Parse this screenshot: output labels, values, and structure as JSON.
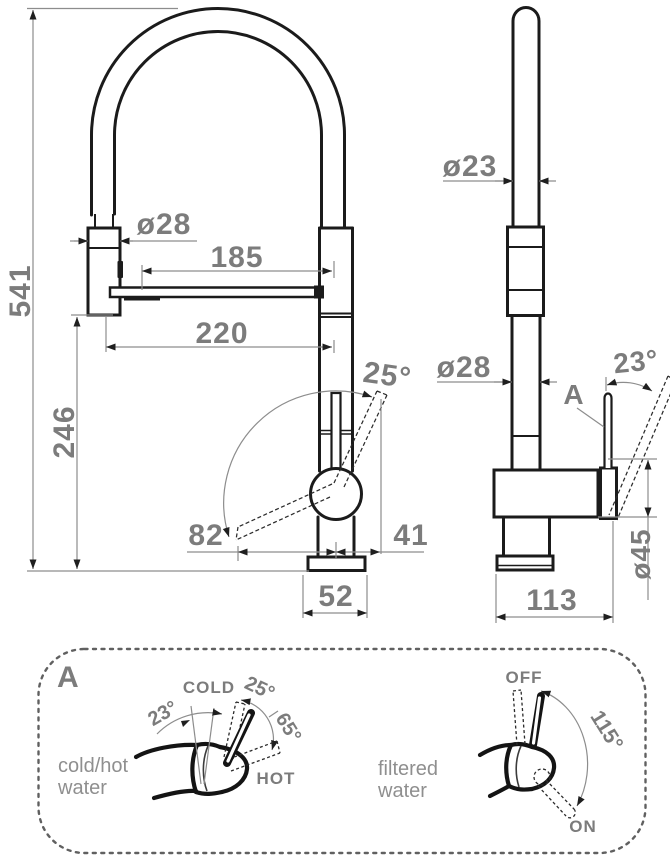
{
  "front": {
    "total_height": "541",
    "spout_height": "246",
    "spray_diameter": "ø28",
    "reach_inner": "185",
    "reach_outer": "220",
    "handle_angle": "25°",
    "handle_back": "82",
    "handle_front": "41",
    "base_width": "52"
  },
  "side": {
    "hose_diameter": "ø23",
    "column_diameter": "ø28",
    "detail_ref": "A",
    "lever_angle": "23°",
    "body_diameter": "ø45",
    "depth": "113"
  },
  "panel": {
    "ref": "A",
    "left": {
      "cold_label": "COLD",
      "rest_angle": "23°",
      "cold_angle": "25°",
      "hot_angle": "65°",
      "hot_label": "HOT",
      "caption_line1": "cold/hot",
      "caption_line2": "water"
    },
    "right": {
      "off_label": "OFF",
      "range_angle": "115°",
      "on_label": "ON",
      "caption_line1": "filtered",
      "caption_line2": "water"
    }
  },
  "colors": {
    "line": "#1b1b1b",
    "dimension": "#8d8d8d",
    "label_text": "#7c7c7c"
  }
}
